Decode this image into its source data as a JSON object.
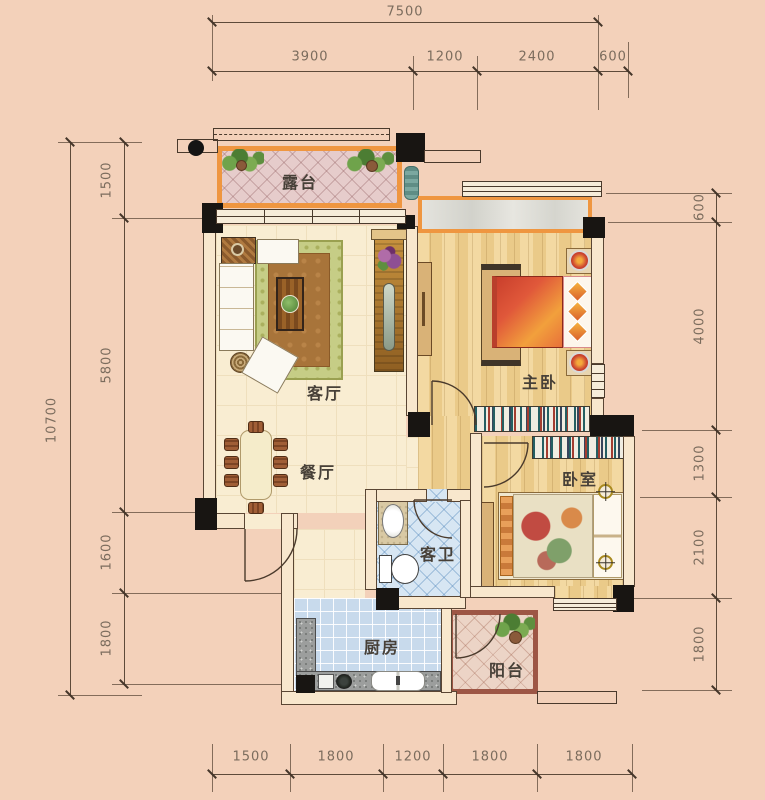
{
  "rooms": {
    "terrace": "露台",
    "living": "客厅",
    "master_bedroom": "主卧",
    "dining": "餐厅",
    "bedroom": "卧室",
    "bathroom": "客卫",
    "kitchen": "厨房",
    "balcony": "阳台"
  },
  "dimensions": {
    "top": {
      "total": "7500",
      "segments": [
        "3900",
        "1200",
        "2400",
        "600"
      ]
    },
    "bottom": {
      "segments": [
        "1500",
        "1800",
        "1200",
        "1800",
        "1800"
      ]
    },
    "left": {
      "total": "10700",
      "segments": [
        "1500",
        "5800",
        "1600",
        "1800"
      ]
    },
    "right": {
      "segments": [
        "600",
        "4000",
        "1300",
        "2100",
        "1800"
      ]
    }
  },
  "colors": {
    "background": "#f3d1ba",
    "terrace_border": "#ef9640",
    "balcony_border": "#9d5645",
    "column": "#181512",
    "wall_line": "#5a4634",
    "dimension_text": "#7b6c5d",
    "wood_floor": "#f0d49c",
    "bath_tile": "#d7e6f3",
    "kitchen_tile": "#c8daec",
    "master_bed": "#d94f35"
  }
}
